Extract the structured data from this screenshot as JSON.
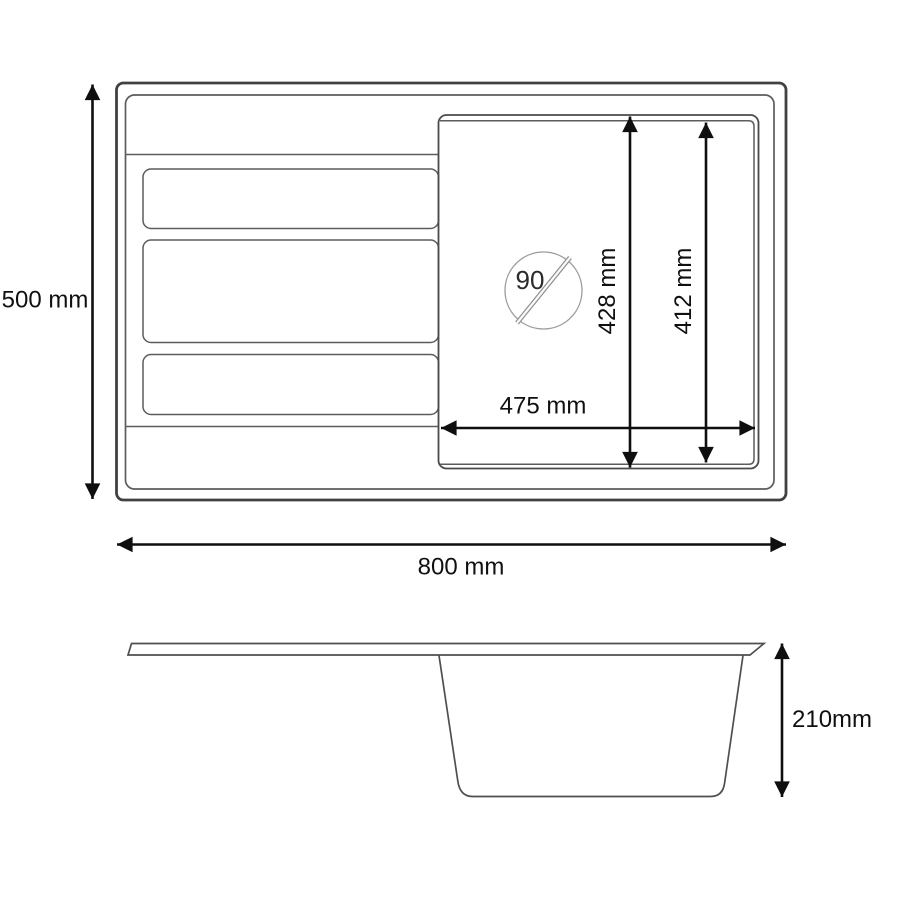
{
  "drawing": {
    "subject": "kitchen-sink-dimension-drawing",
    "labels": {
      "overall_depth": "500 mm",
      "overall_width": "800 mm",
      "basin_width": "475 mm",
      "basin_depth_outer": "428 mm",
      "basin_depth_inner": "412 mm",
      "drain_diameter": "90",
      "bowl_height": "210mm"
    },
    "colors": {
      "line_dark": "#414141",
      "line_mid": "#5c5c5c",
      "dimension": "#0f0f0f",
      "background": "#ffffff"
    }
  }
}
